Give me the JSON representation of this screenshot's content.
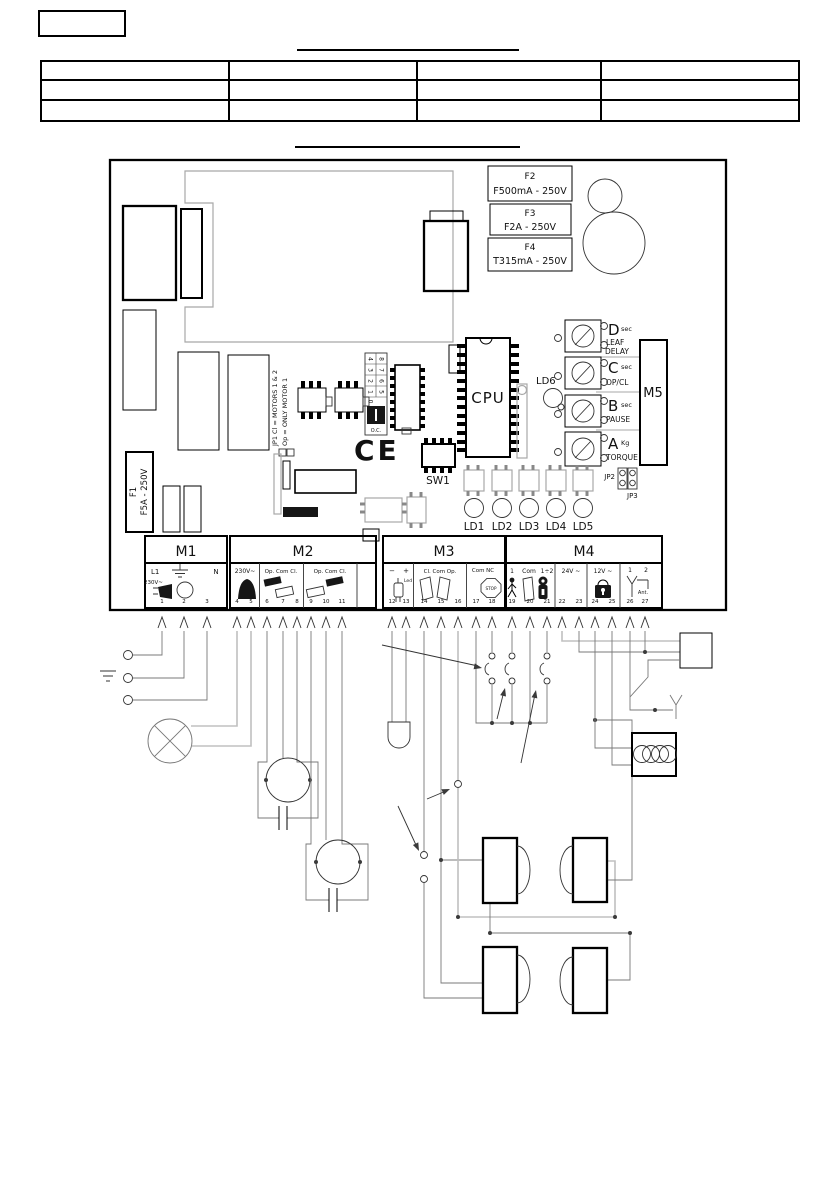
{
  "colors": {
    "ink": "#000000",
    "trace_gray": "#a8a8a8"
  },
  "table": {
    "rows": 3,
    "cols": 4
  },
  "board": {
    "fuse_f1": {
      "name": "F1",
      "rating": "F5A - 250V"
    },
    "fuses": [
      {
        "name": "F2",
        "rating": "F500mA - 250V"
      },
      {
        "name": "F3",
        "rating": "F2A - 250V"
      },
      {
        "name": "F4",
        "rating": "T315mA - 250V"
      }
    ],
    "cpu_label": "CPU",
    "sw1_label": "SW1",
    "m5_label": "M5",
    "ce_mark": "CE",
    "jp1_line1": "JP1 Cl = MOTORS 1 & 2",
    "jp1_line2": "Op = ONLY MOTOR 1",
    "jp2_label": "JP2",
    "jp3_label": "JP3",
    "ld6_label": "LD6",
    "led_labels": [
      "LD1",
      "LD2",
      "LD3",
      "LD4",
      "LD5"
    ],
    "dial": {
      "left_digits": [
        "4",
        "3",
        "2",
        "1",
        "0"
      ],
      "right_digits": [
        "8",
        "7",
        "6",
        "5"
      ],
      "oc": "O.C."
    },
    "trimmers": [
      {
        "letter": "D",
        "unit": "sec",
        "func1": "LEAF",
        "func2": "DELAY"
      },
      {
        "letter": "C",
        "unit": "sec",
        "func1": "OP/CL",
        "func2": ""
      },
      {
        "letter": "B",
        "unit": "sec",
        "func1": "PAUSE",
        "func2": ""
      },
      {
        "letter": "A",
        "unit": "Kg",
        "func1": "TORQUE",
        "func2": ""
      }
    ]
  },
  "terminals": {
    "m1": {
      "label": "M1",
      "l1": "L1",
      "n": "N",
      "voltage": "230V~",
      "pins": [
        "1",
        "2",
        "3"
      ]
    },
    "m2": {
      "label": "M2",
      "s1_top": "230V~",
      "s2_top": "Op. Com Cl.",
      "s3_top": "Op. Com Cl.",
      "s1_pins": [
        "4",
        "5"
      ],
      "s2_pins": [
        "6",
        "7",
        "8"
      ],
      "s3_pins": [
        "9",
        "10",
        "11"
      ]
    },
    "m3": {
      "label": "M3",
      "s1_minus": "−",
      "s1_plus": "+",
      "s1_led": "Led",
      "s2_top": "Cl. Com Op.",
      "s3_top": "Com NC",
      "stop": "STOP",
      "s1_pins": [
        "12",
        "13"
      ],
      "s2_pins": [
        "14",
        "15",
        "16"
      ],
      "s3_pins": [
        "17",
        "18"
      ]
    },
    "m4": {
      "label": "M4",
      "s1_n1": "1",
      "s1_n2": "Com",
      "s1_n3": "1÷2",
      "s2_top": "24V ~",
      "s3_top": "12V ~",
      "s4_n1": "1",
      "s4_n2": "2",
      "s4_ant": "Ant.",
      "s1_pins": [
        "19",
        "20",
        "21"
      ],
      "s2_pins": [
        "22",
        "23"
      ],
      "s3_pins": [
        "24",
        "25"
      ],
      "s4_pins": [
        "26",
        "27"
      ]
    }
  }
}
